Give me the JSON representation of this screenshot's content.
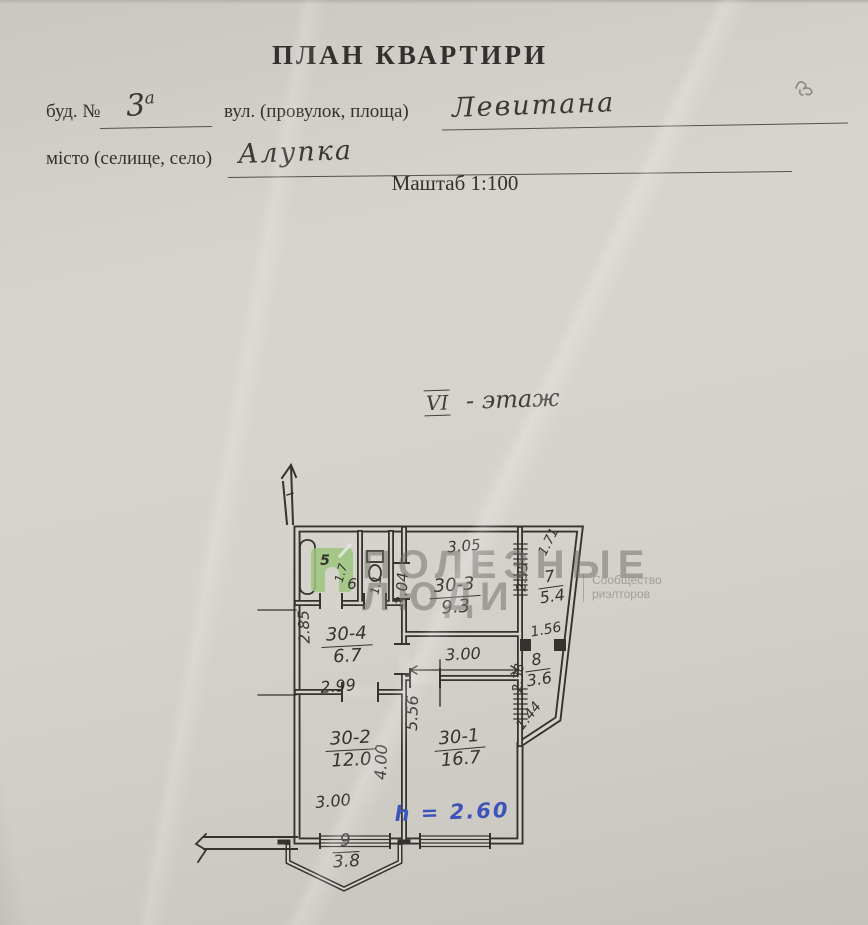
{
  "header": {
    "title": "ПЛАН КВАРТИРИ",
    "building_label": "буд. №",
    "building_number": "3",
    "building_letter": "а",
    "street_label": "вул. (провулок, площа)",
    "street_value": "Левитана",
    "city_label": "місто (селище, село)",
    "city_value": "Алупка",
    "scale_text": "Маштаб 1:100"
  },
  "floor_note": {
    "numeral": "VI",
    "text": "- этаж"
  },
  "watermark": {
    "line1": "ПОЛЕЗНЫЕ",
    "line2": "ЛЮДИ",
    "sub_line1": "Сообщество",
    "sub_line2": "риэлторов",
    "logo_color": "#9cc57e"
  },
  "plan": {
    "ink_color": "#35332f",
    "blue_ink": "#3c55bb",
    "height_note": "h = 2.60",
    "rooms": [
      {
        "id": "5",
        "area": "1.7"
      },
      {
        "id": "6",
        "area": "1.1"
      },
      {
        "id": "30-3",
        "area": "9.3"
      },
      {
        "id": "7",
        "area": "5.4"
      },
      {
        "id": "8",
        "area": "3.6"
      },
      {
        "id": "30-4",
        "area": "6.7"
      },
      {
        "id": "30-2",
        "area": "12.0"
      },
      {
        "id": "30-1",
        "area": "16.7"
      },
      {
        "id": "9",
        "area": "3.8"
      }
    ],
    "dimensions": {
      "kitchen_width": "3.05",
      "kitchen_depth": "3.04",
      "hall_width": "3.00",
      "corridor_width": "2.99",
      "corridor_depth": "2.85",
      "room2_width": "3.00",
      "room2_depth": "4.00",
      "room1_depth": "5.56",
      "loggia7_top": "1.71",
      "loggia7_side": "2.95",
      "loggia_mid": "1.56",
      "loggia8_side": "2.38",
      "loggia8_diag": "1.44"
    }
  }
}
